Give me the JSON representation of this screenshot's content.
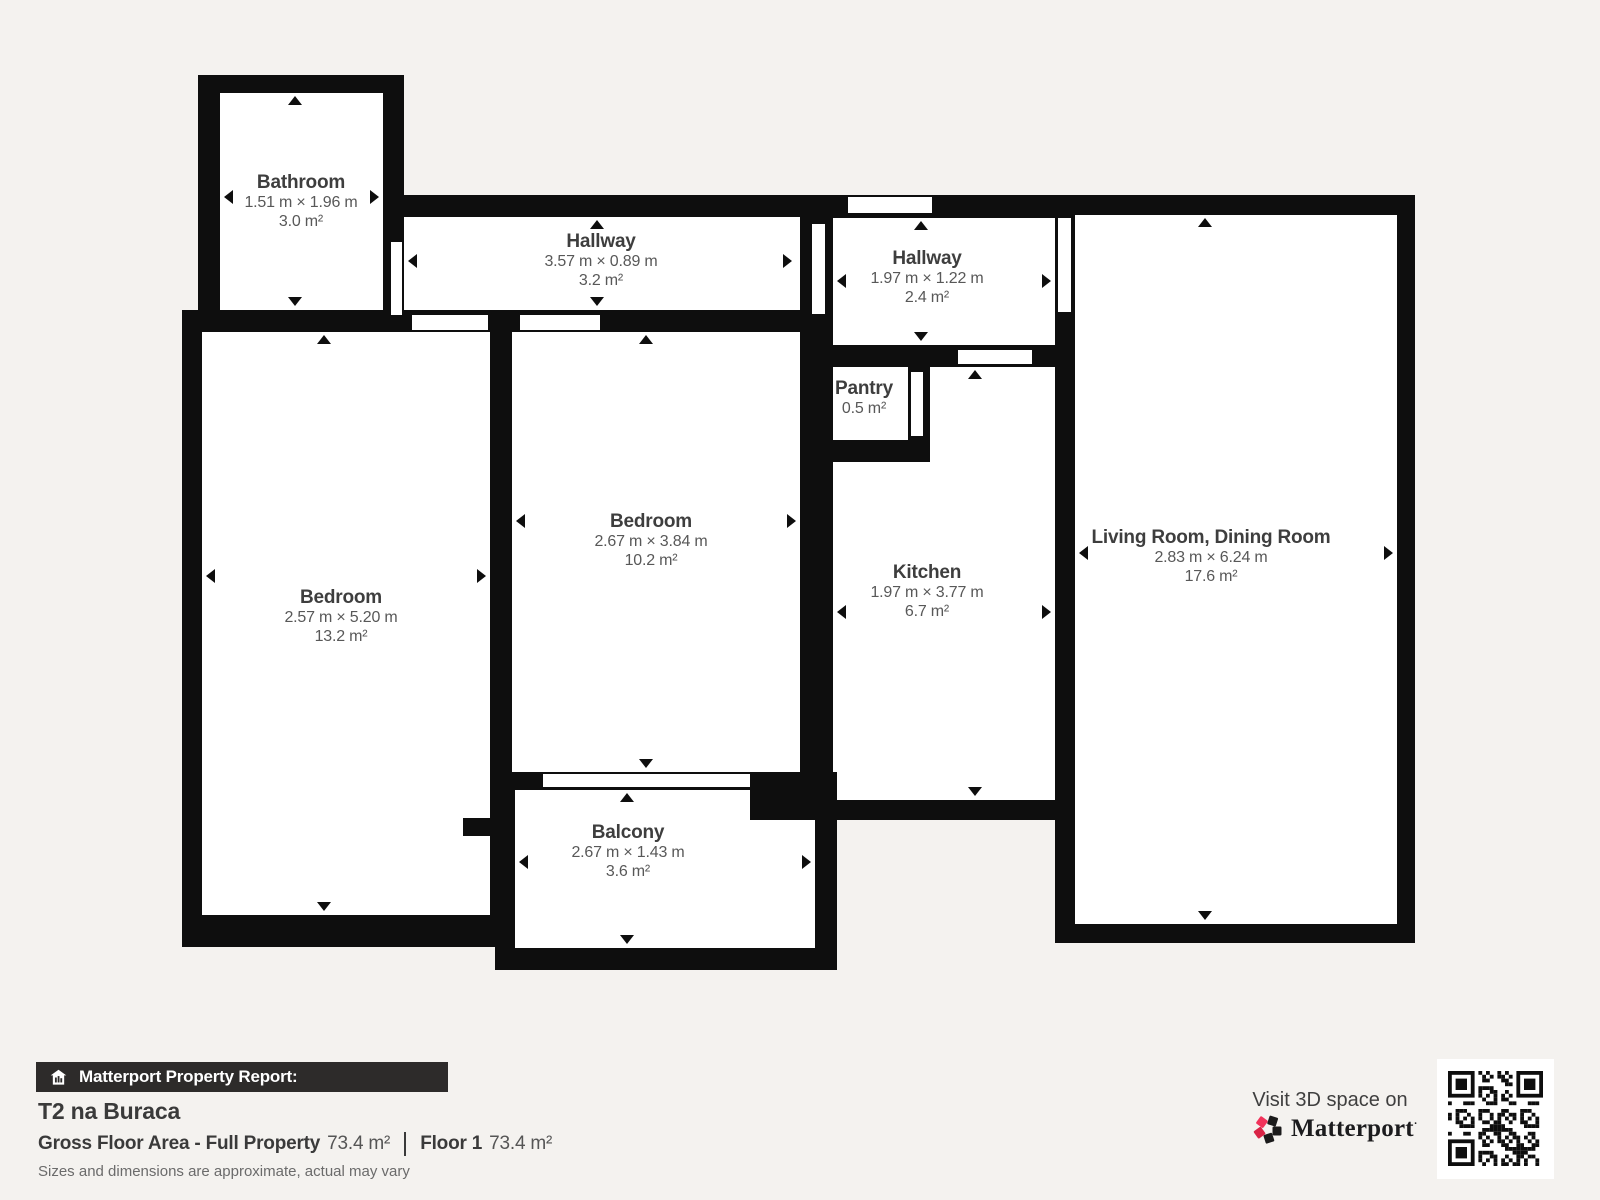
{
  "colors": {
    "background": "#f4f2ef",
    "wall": "#0e0e0e",
    "room_title": "#3e3e3e",
    "room_dims": "#585858",
    "footer_bar_bg": "#2d2b2a",
    "brand_pink": "#f1335a"
  },
  "rooms": [
    {
      "id": "bathroom",
      "name": "Bathroom",
      "dimensions": "1.51 m × 1.96 m",
      "area": "3.0 m²"
    },
    {
      "id": "hallway-top",
      "name": "Hallway",
      "dimensions": "3.57 m × 0.89 m",
      "area": "3.2 m²"
    },
    {
      "id": "hallway-right",
      "name": "Hallway",
      "dimensions": "1.97 m × 1.22 m",
      "area": "2.4 m²"
    },
    {
      "id": "pantry",
      "name": "Pantry",
      "dimensions": "",
      "area": "0.5 m²"
    },
    {
      "id": "bedroom-center",
      "name": "Bedroom",
      "dimensions": "2.67 m × 3.84 m",
      "area": "10.2 m²"
    },
    {
      "id": "bedroom-left",
      "name": "Bedroom",
      "dimensions": "2.57 m × 5.20 m",
      "area": "13.2 m²"
    },
    {
      "id": "kitchen",
      "name": "Kitchen",
      "dimensions": "1.97 m × 3.77 m",
      "area": "6.7 m²"
    },
    {
      "id": "living-room",
      "name": "Living Room, Dining Room",
      "dimensions": "2.83 m × 6.24 m",
      "area": "17.6 m²"
    },
    {
      "id": "balcony",
      "name": "Balcony",
      "dimensions": "2.67 m × 1.43 m",
      "area": "3.6 m²"
    }
  ],
  "report": {
    "bar_label": "Matterport Property Report:",
    "property_name": "T2 na Buraca",
    "gross_label": "Gross Floor Area - Full Property",
    "gross_value": "73.4 m²",
    "floor_label": "Floor 1",
    "floor_value": "73.4 m²",
    "disclaimer": "Sizes and dimensions are approximate, actual may vary"
  },
  "cta": {
    "visit_text": "Visit 3D space on",
    "brand": "Matterport",
    "brand_mark": "·"
  }
}
